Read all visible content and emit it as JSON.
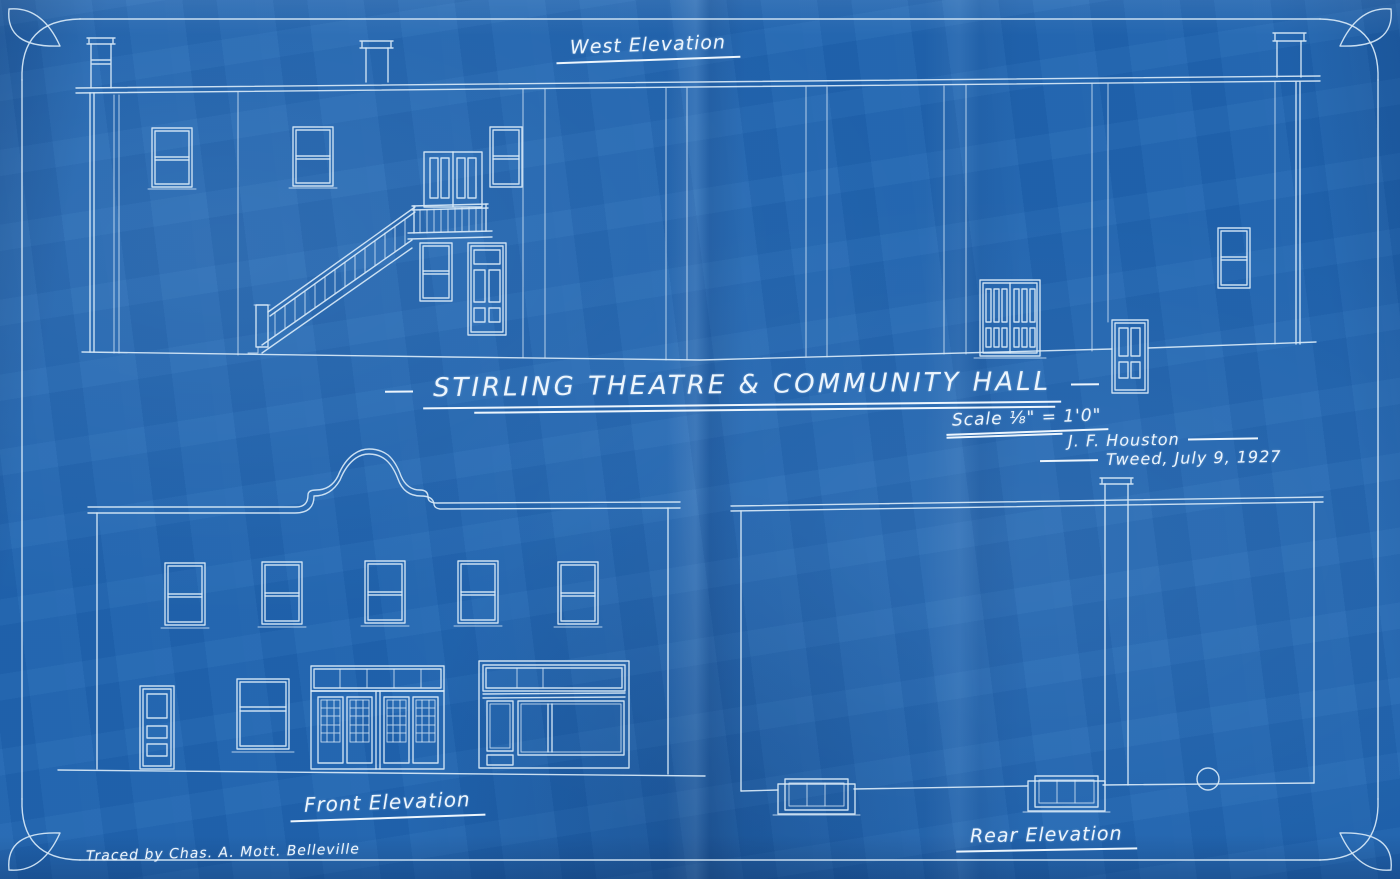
{
  "colors": {
    "paper": "#2166b2",
    "line": "#d8e9f7",
    "text": "#ecf5fd"
  },
  "labels": {
    "west_elevation": "West Elevation",
    "title": "STIRLING THEATRE & COMMUNITY HALL",
    "scale": "Scale ⅛\" = 1'0\"",
    "architect": "J. F. Houston",
    "place_date": "Tweed, July 9, 1927",
    "front_elevation": "Front Elevation",
    "rear_elevation": "Rear Elevation",
    "credit": "Traced by Chas. A. Mott. Belleville"
  }
}
